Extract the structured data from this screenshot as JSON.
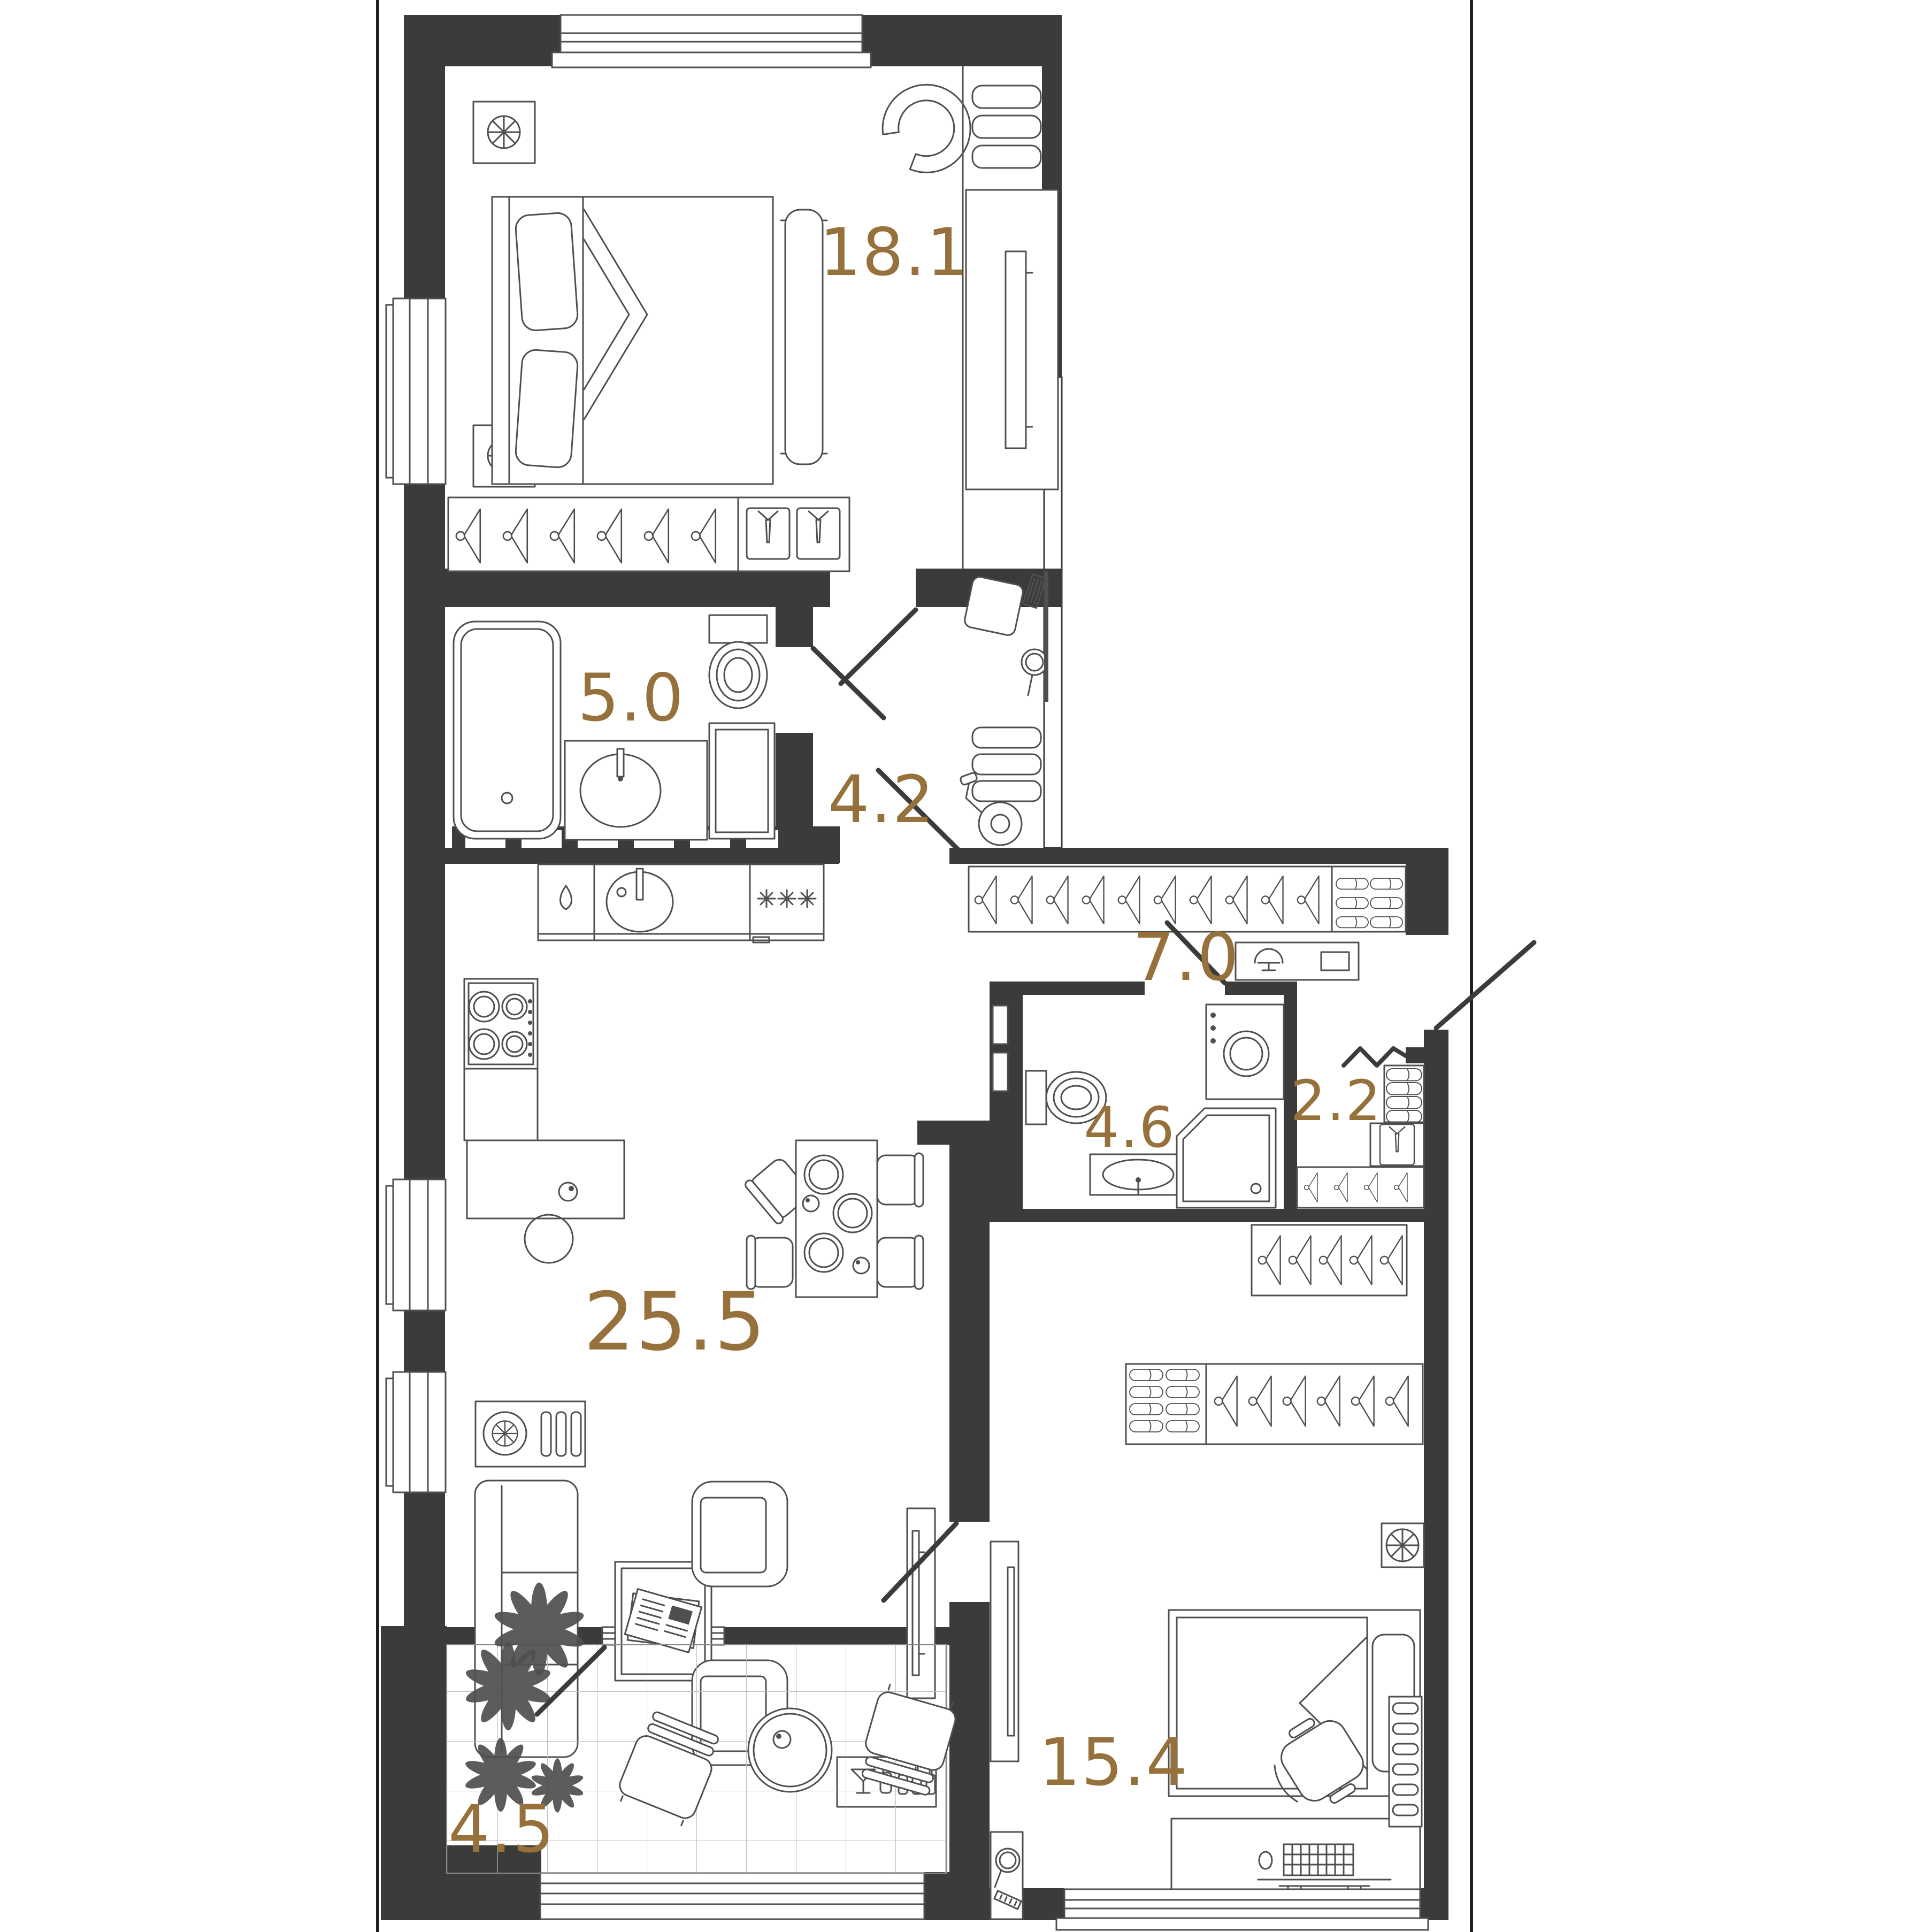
{
  "plan": {
    "type": "apartment-floor-plan",
    "accent_color": "#97713B",
    "wall_color": "#3B3B39",
    "furniture_line_color": "#4F4F4D",
    "frame_line_color": "#1F1F1D",
    "rooms": [
      {
        "id": "bedroom-main",
        "name": "bedroom",
        "area": "18.1"
      },
      {
        "id": "bathroom-main",
        "name": "bathroom",
        "area": "5.0"
      },
      {
        "id": "hallway",
        "name": "hallway",
        "area": "4.2"
      },
      {
        "id": "corridor",
        "name": "corridor",
        "area": "7.0"
      },
      {
        "id": "bathroom-guest",
        "name": "guest bathroom",
        "area": "4.6"
      },
      {
        "id": "closet",
        "name": "closet",
        "area": "2.2"
      },
      {
        "id": "living-kitchen",
        "name": "living room / kitchen",
        "area": "25.5"
      },
      {
        "id": "bedroom-second",
        "name": "second bedroom",
        "area": "15.4"
      },
      {
        "id": "balcony",
        "name": "balcony",
        "area": "4.5"
      }
    ]
  }
}
